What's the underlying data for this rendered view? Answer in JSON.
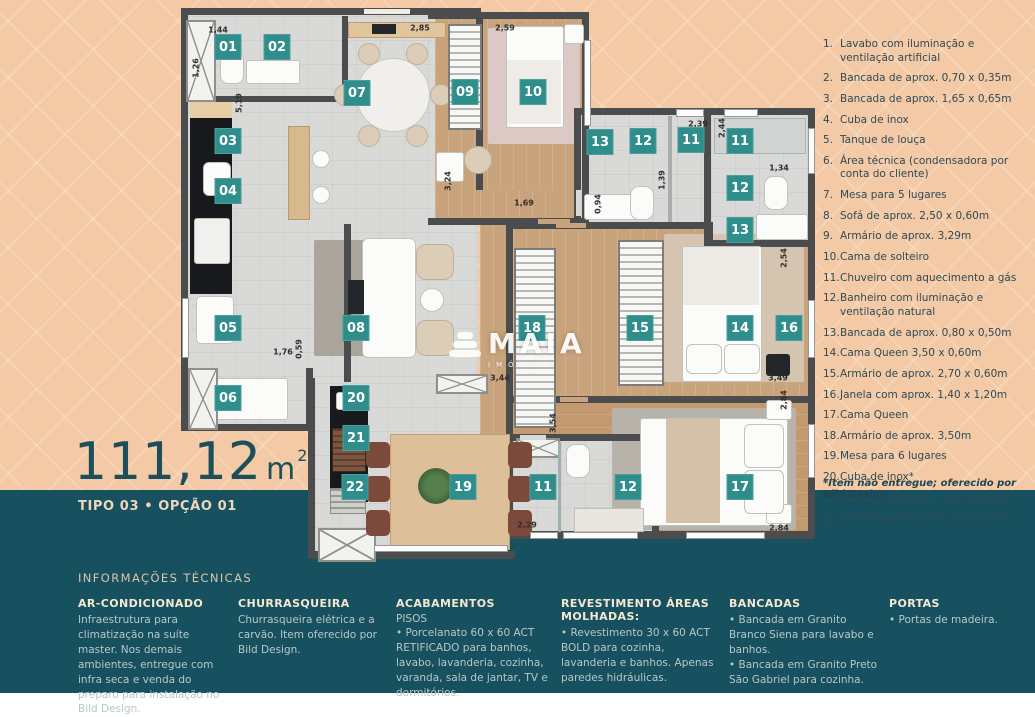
{
  "title": {
    "area_value": "111,12",
    "area_unit": "m",
    "area_sup": "2",
    "type_label": "TIPO 03 • OPÇÃO 01"
  },
  "watermark": {
    "brand": "MAIA",
    "sub": "IMÓVEIS"
  },
  "legend": {
    "items": [
      {
        "num": "1.",
        "text": "Lavabo com iluminação e ventilação artificial"
      },
      {
        "num": "2.",
        "text": "Bancada de aprox. 0,70 x 0,35m"
      },
      {
        "num": "3.",
        "text": "Bancada de aprox. 1,65 x 0,65m"
      },
      {
        "num": "4.",
        "text": "Cuba de inox"
      },
      {
        "num": "5.",
        "text": "Tanque de louça"
      },
      {
        "num": "6.",
        "text": "Área técnica (condensadora por conta do cliente)"
      },
      {
        "num": "7.",
        "text": "Mesa para 5 lugares"
      },
      {
        "num": "8.",
        "text": "Sofá de aprox. 2,50 x 0,60m"
      },
      {
        "num": "9.",
        "text": "Armário de aprox. 3,29m"
      },
      {
        "num": "10.",
        "text": "Cama de solteiro"
      },
      {
        "num": "11.",
        "text": "Chuveiro com aquecimento a gás"
      },
      {
        "num": "12.",
        "text": "Banheiro com iluminação e ventilação natural"
      },
      {
        "num": "13.",
        "text": "Bancada de aprox. 0,80 x 0,50m"
      },
      {
        "num": "14.",
        "text": "Cama Queen 3,50 x 0,60m"
      },
      {
        "num": "15.",
        "text": "Armário de aprox. 2,70 x 0,60m"
      },
      {
        "num": "16.",
        "text": "Janela com aprox. 1,40 x 1,20m"
      },
      {
        "num": "17.",
        "text": "Cama Queen"
      },
      {
        "num": "18.",
        "text": "Armário de aprox. 3,50m"
      },
      {
        "num": "19.",
        "text": "Mesa para 6 lugares"
      },
      {
        "num": "20.",
        "text": "Cuba de inox*"
      },
      {
        "num": "21.",
        "text": "Bancada de aprox. 2,20 x 0,65m"
      },
      {
        "num": "22.",
        "text": "Churrasqueira elétrica ou carvão*"
      }
    ],
    "footnote": "*Item não entregue; oferecido por Bild Design."
  },
  "tech": {
    "heading": "INFORMAÇÕES TÉCNICAS",
    "columns": [
      {
        "title": "AR-CONDICIONADO",
        "body": "Infraestrutura para climatização na suíte master. Nos demais ambientes, entregue com infra seca e venda do preparo para instalação no Bild Design."
      },
      {
        "title": "CHURRASQUEIRA",
        "body": "Churrasqueira elétrica e a carvão. Item oferecido por Bild Design."
      },
      {
        "title": "ACABAMENTOS",
        "subtitle": "PISOS",
        "body": "• Porcelanato 60 x 60 ACT RETIFICADO para banhos, lavabo, lavanderia, cozinha, varanda, sala de jantar, TV e dormitórios."
      },
      {
        "title": "REVESTIMENTO ÁREAS MOLHADAS:",
        "body": "• Revestimento 30 x 60 ACT BOLD para cozinha, lavanderia e banhos. Apenas paredes hidráulicas."
      },
      {
        "title": "BANCADAS",
        "body": "• Bancada em Granito Branco Siena para lavabo e banhos.\n• Bancada em Granito Preto São Gabriel para cozinha."
      },
      {
        "title": "PORTAS",
        "body": "• Portas de madeira."
      }
    ]
  },
  "plan": {
    "badges": [
      {
        "n": "01",
        "x": 228,
        "y": 47
      },
      {
        "n": "02",
        "x": 277,
        "y": 47
      },
      {
        "n": "03",
        "x": 228,
        "y": 141
      },
      {
        "n": "04",
        "x": 228,
        "y": 191
      },
      {
        "n": "05",
        "x": 228,
        "y": 328
      },
      {
        "n": "06",
        "x": 228,
        "y": 398
      },
      {
        "n": "07",
        "x": 357,
        "y": 93
      },
      {
        "n": "08",
        "x": 356,
        "y": 328
      },
      {
        "n": "09",
        "x": 465,
        "y": 92
      },
      {
        "n": "10",
        "x": 533,
        "y": 92
      },
      {
        "n": "13",
        "x": 600,
        "y": 142
      },
      {
        "n": "12",
        "x": 643,
        "y": 141
      },
      {
        "n": "11",
        "x": 691,
        "y": 140
      },
      {
        "n": "11",
        "x": 740,
        "y": 141
      },
      {
        "n": "12",
        "x": 740,
        "y": 188
      },
      {
        "n": "13",
        "x": 740,
        "y": 230
      },
      {
        "n": "18",
        "x": 532,
        "y": 328
      },
      {
        "n": "15",
        "x": 640,
        "y": 328
      },
      {
        "n": "14",
        "x": 740,
        "y": 328
      },
      {
        "n": "16",
        "x": 789,
        "y": 328
      },
      {
        "n": "20",
        "x": 356,
        "y": 398
      },
      {
        "n": "21",
        "x": 356,
        "y": 438
      },
      {
        "n": "22",
        "x": 355,
        "y": 487
      },
      {
        "n": "19",
        "x": 463,
        "y": 487
      },
      {
        "n": "11",
        "x": 543,
        "y": 487
      },
      {
        "n": "12",
        "x": 628,
        "y": 487
      },
      {
        "n": "17",
        "x": 740,
        "y": 487
      }
    ],
    "dims": [
      {
        "t": "1,44",
        "x": 218,
        "y": 30,
        "v": false
      },
      {
        "t": "2,85",
        "x": 420,
        "y": 28,
        "v": false
      },
      {
        "t": "2,59",
        "x": 505,
        "y": 28,
        "v": false
      },
      {
        "t": "1,26",
        "x": 196,
        "y": 68,
        "v": true
      },
      {
        "t": "5,19",
        "x": 239,
        "y": 103,
        "v": true
      },
      {
        "t": "3,24",
        "x": 448,
        "y": 181,
        "v": true
      },
      {
        "t": "2,39",
        "x": 698,
        "y": 124,
        "v": false
      },
      {
        "t": "2,44",
        "x": 722,
        "y": 128,
        "v": true
      },
      {
        "t": "1,34",
        "x": 779,
        "y": 168,
        "v": false
      },
      {
        "t": "1,69",
        "x": 524,
        "y": 203,
        "v": false
      },
      {
        "t": "0,94",
        "x": 598,
        "y": 204,
        "v": true
      },
      {
        "t": "1,39",
        "x": 662,
        "y": 180,
        "v": true
      },
      {
        "t": "2,54",
        "x": 784,
        "y": 258,
        "v": true
      },
      {
        "t": "1,76",
        "x": 283,
        "y": 352,
        "v": false
      },
      {
        "t": "0,59",
        "x": 299,
        "y": 349,
        "v": true
      },
      {
        "t": "3,44",
        "x": 500,
        "y": 378,
        "v": false
      },
      {
        "t": "3,49",
        "x": 778,
        "y": 378,
        "v": false
      },
      {
        "t": "2,84",
        "x": 784,
        "y": 400,
        "v": true
      },
      {
        "t": "3,54",
        "x": 553,
        "y": 423,
        "v": true
      },
      {
        "t": "2,29",
        "x": 527,
        "y": 525,
        "v": false
      },
      {
        "t": "2,84",
        "x": 779,
        "y": 528,
        "v": false
      }
    ]
  },
  "colors": {
    "background_peach": "#f4c9a5",
    "band_teal": "#17505e",
    "badge_teal": "#2f8e8c",
    "title_teal": "#1d4f5a",
    "legend_text": "#2e4b57",
    "tech_title": "#f5e7d2",
    "tech_body": "#b7c8c8",
    "wall_gray": "#4b4c4e",
    "wood_floor": "#c9a37b"
  }
}
